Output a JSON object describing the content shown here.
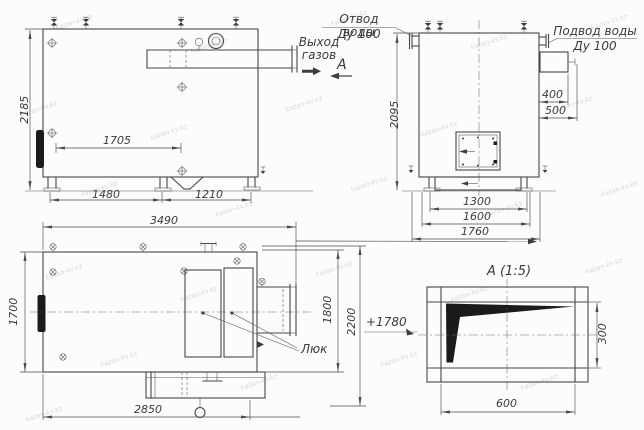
{
  "drawing": {
    "front_view": {
      "height": "2185",
      "upper_width": "1705",
      "base_left": "1480",
      "base_right": "1210",
      "gas_outlet_label": "Выход газов"
    },
    "side_view": {
      "height": "2095",
      "water_outlet_line1": "Отвод воды",
      "water_outlet_line2": "Ду 100",
      "water_inlet_line1": "Подвод воды",
      "water_inlet_line2": "Ду 100",
      "nozzle_offset_top": "400",
      "nozzle_offset_bottom": "500",
      "base_inner": "1300",
      "base_mid": "1600",
      "base_outer": "1760",
      "section_label": "А"
    },
    "plan_view": {
      "length": "3490",
      "width": "1700",
      "inner_width": "1800",
      "outer_width": "2200",
      "bottom_length": "2850",
      "hatch_label": "Люк",
      "elevation_mark": "+1780"
    },
    "detail_view": {
      "title": "А (1:5)",
      "height": "300",
      "width": "600"
    }
  },
  "watermark": {
    "text": "kazan-kv.kz"
  },
  "colors": {
    "line": "#474747",
    "dimension": "#4c4c4c",
    "fill_black": "#1b1b1b",
    "background": "#fcfcfb",
    "watermark": "#c9c3bd"
  }
}
